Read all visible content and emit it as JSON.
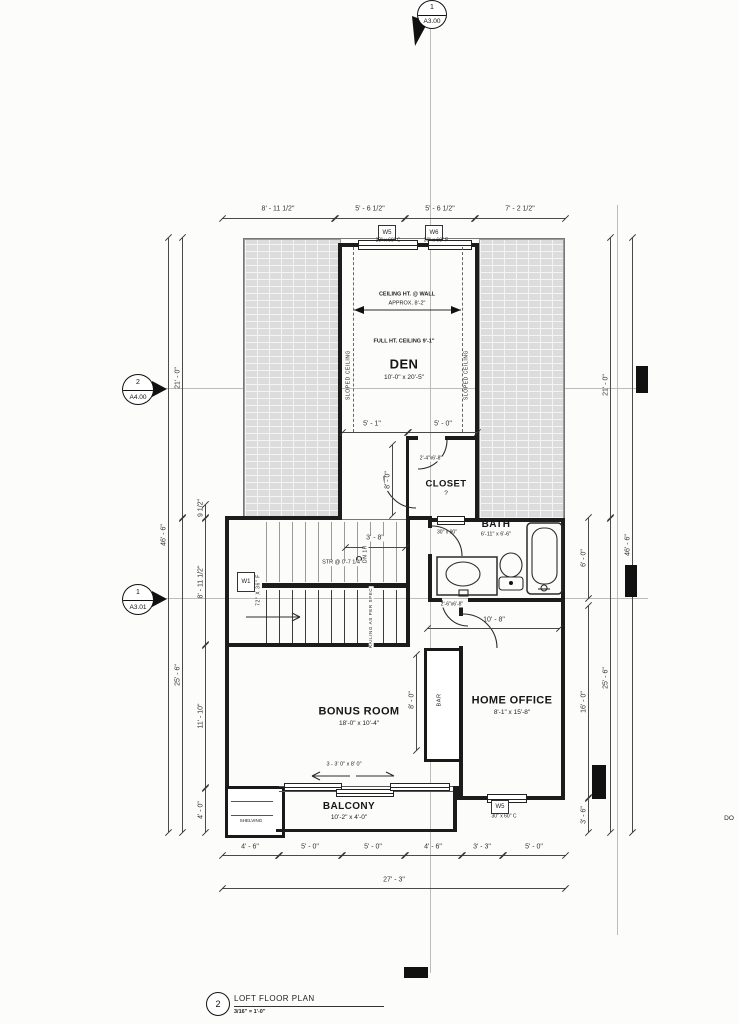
{
  "markers": {
    "section_top": {
      "number": "1",
      "sheet": "A3.00"
    },
    "section_left_upper": {
      "number": "2",
      "sheet": "A4.00"
    },
    "section_left_lower": {
      "number": "1",
      "sheet": "A3.01"
    }
  },
  "title_block": {
    "detail_number": "2",
    "title": "LOFT FLOOR PLAN",
    "scale": "3/16\" = 1'-0\""
  },
  "rooms": {
    "den": {
      "name": "DEN",
      "size": "10'-0\" x 20'-5\""
    },
    "closet": {
      "name": "CLOSET",
      "tag": "?"
    },
    "bath": {
      "name": "BATH",
      "size": "6'-11\" x 6'-6\""
    },
    "bonus_room": {
      "name": "BONUS ROOM",
      "size": "18'-0\" x 10'-4\""
    },
    "home_office": {
      "name": "HOME OFFICE",
      "size": "8'-1\" x 15'-8\""
    },
    "balcony": {
      "name": "BALCONY",
      "size": "10'-2\" x 4'-0\""
    },
    "bar": {
      "name": "BAR"
    },
    "shelving": {
      "name": "SHELVING"
    }
  },
  "windows": {
    "w5_top": {
      "tag": "W5",
      "size": "30\" x 60\" C"
    },
    "w6_top": {
      "tag": "W6",
      "size": "30\" x 60\" F"
    },
    "w1_stair": {
      "tag": "W1",
      "size": "72\" X 36\" F"
    },
    "bath_window_size": "30\" x 90\"",
    "w5_office": {
      "tag": "W5",
      "size": "30\" x 60\" C"
    }
  },
  "doors": {
    "closet_door": "2'-4\"x6'-8\"",
    "bath_door": "2'-6\"x6'-8\"",
    "balcony_doors": "3 - 3' 0\" x 8' 0\""
  },
  "notes": {
    "ceiling_at_wall_1": "CEILING HT. @ WALL",
    "ceiling_at_wall_2": "APPROX. 8'-2\"",
    "full_height_ceiling": "FULL HT. CEILING 9'-1\"",
    "sloped_ceiling_left": "SLOPED CEILING",
    "sloped_ceiling_right": "SLOPED CEILING",
    "stair_riser": "STR @ 0'-7 1/4\"",
    "down_one_riser": "DN 1R",
    "railing": "RAILING AS PER SPEC",
    "edge_text": "DO"
  },
  "dimensions": {
    "top": [
      "8' - 11 1/2\"",
      "5' - 6 1/2\"",
      "5' - 6 1/2\"",
      "7' - 2 1/2\""
    ],
    "bottom": [
      "4' - 6\"",
      "5' - 0\"",
      "5' - 0\"",
      "4' - 6\"",
      "3' - 3\"",
      "5' - 0\""
    ],
    "bottom_total": "27' - 3\"",
    "left_outer": "46' - 6\"",
    "left_mid_upper": "21' - 0\"",
    "left_mid_lower": "25' - 6\"",
    "left_inner": [
      "9 1/2\"",
      "8' - 11 1/2\"",
      "11' - 10\"",
      "4' - 0\""
    ],
    "right_outer": "46' - 6\"",
    "right_mid_upper": "21' - 0\"",
    "right_mid_lower": "25' - 6\"",
    "right_inner": [
      "6' - 0\"",
      "16' - 0\"",
      "3' - 6\""
    ],
    "den_split": [
      "5' - 1\"",
      "5' - 0\""
    ],
    "stair_top": "3' - 8\"",
    "hall": "10' - 8\"",
    "bar_height": "8' - 0\"",
    "closet_depth": "8' - 0\""
  }
}
